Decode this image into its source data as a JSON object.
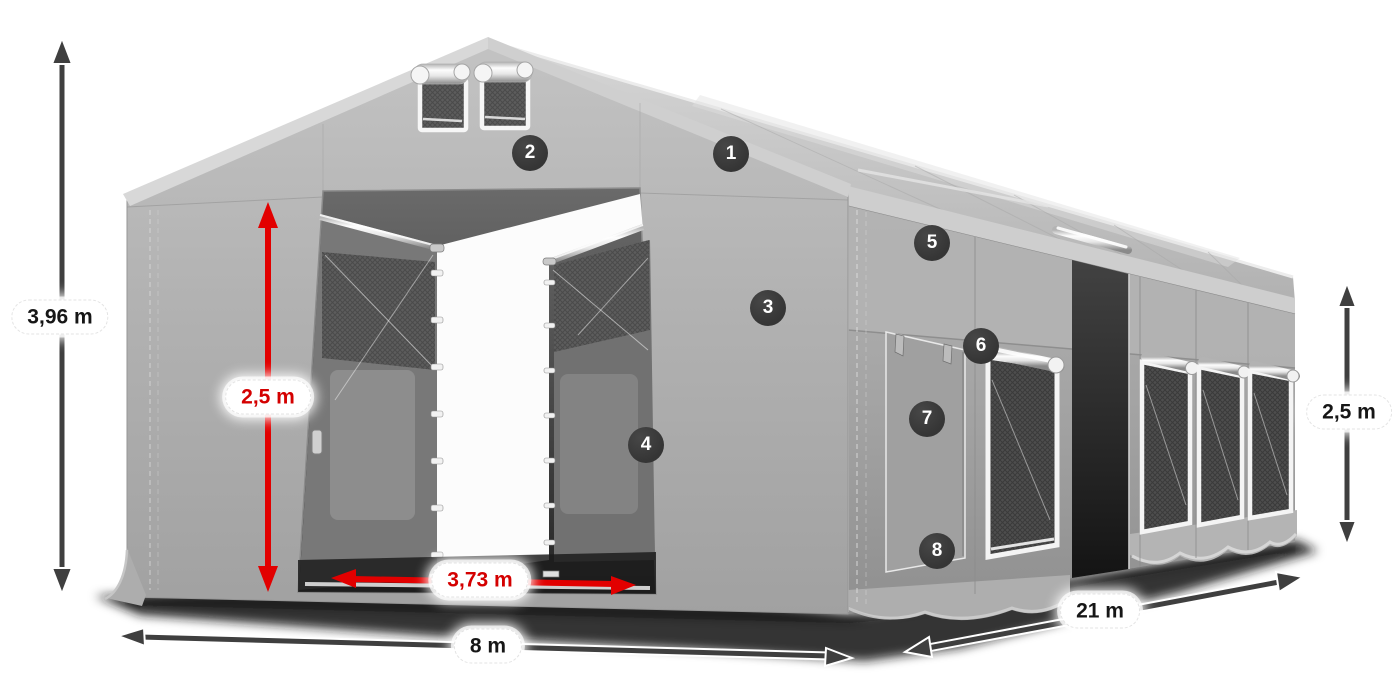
{
  "diagram": {
    "dimensions": {
      "total_height": "3,96 m",
      "entrance_height": "2,5 m",
      "entrance_width": "3,73 m",
      "front_width": "8 m",
      "side_length": "21 m",
      "side_height": "2,5 m"
    },
    "hotspots": [
      {
        "label": "1"
      },
      {
        "label": "2"
      },
      {
        "label": "3"
      },
      {
        "label": "4"
      },
      {
        "label": "5"
      },
      {
        "label": "6"
      },
      {
        "label": "7"
      },
      {
        "label": "8"
      }
    ],
    "colors": {
      "arrow_dark": "#3f3f3f",
      "arrow_red": "#e20000",
      "label_text_dark": "#161616",
      "label_text_red": "#d40000",
      "badge_background": "#353535",
      "badge_text": "#ffffff",
      "canvas_background": "#ffffff",
      "tent_fabric_light": "#c9c9c9",
      "tent_fabric_mid": "#ababab",
      "tent_fabric_dark": "#8f8f8f"
    }
  }
}
